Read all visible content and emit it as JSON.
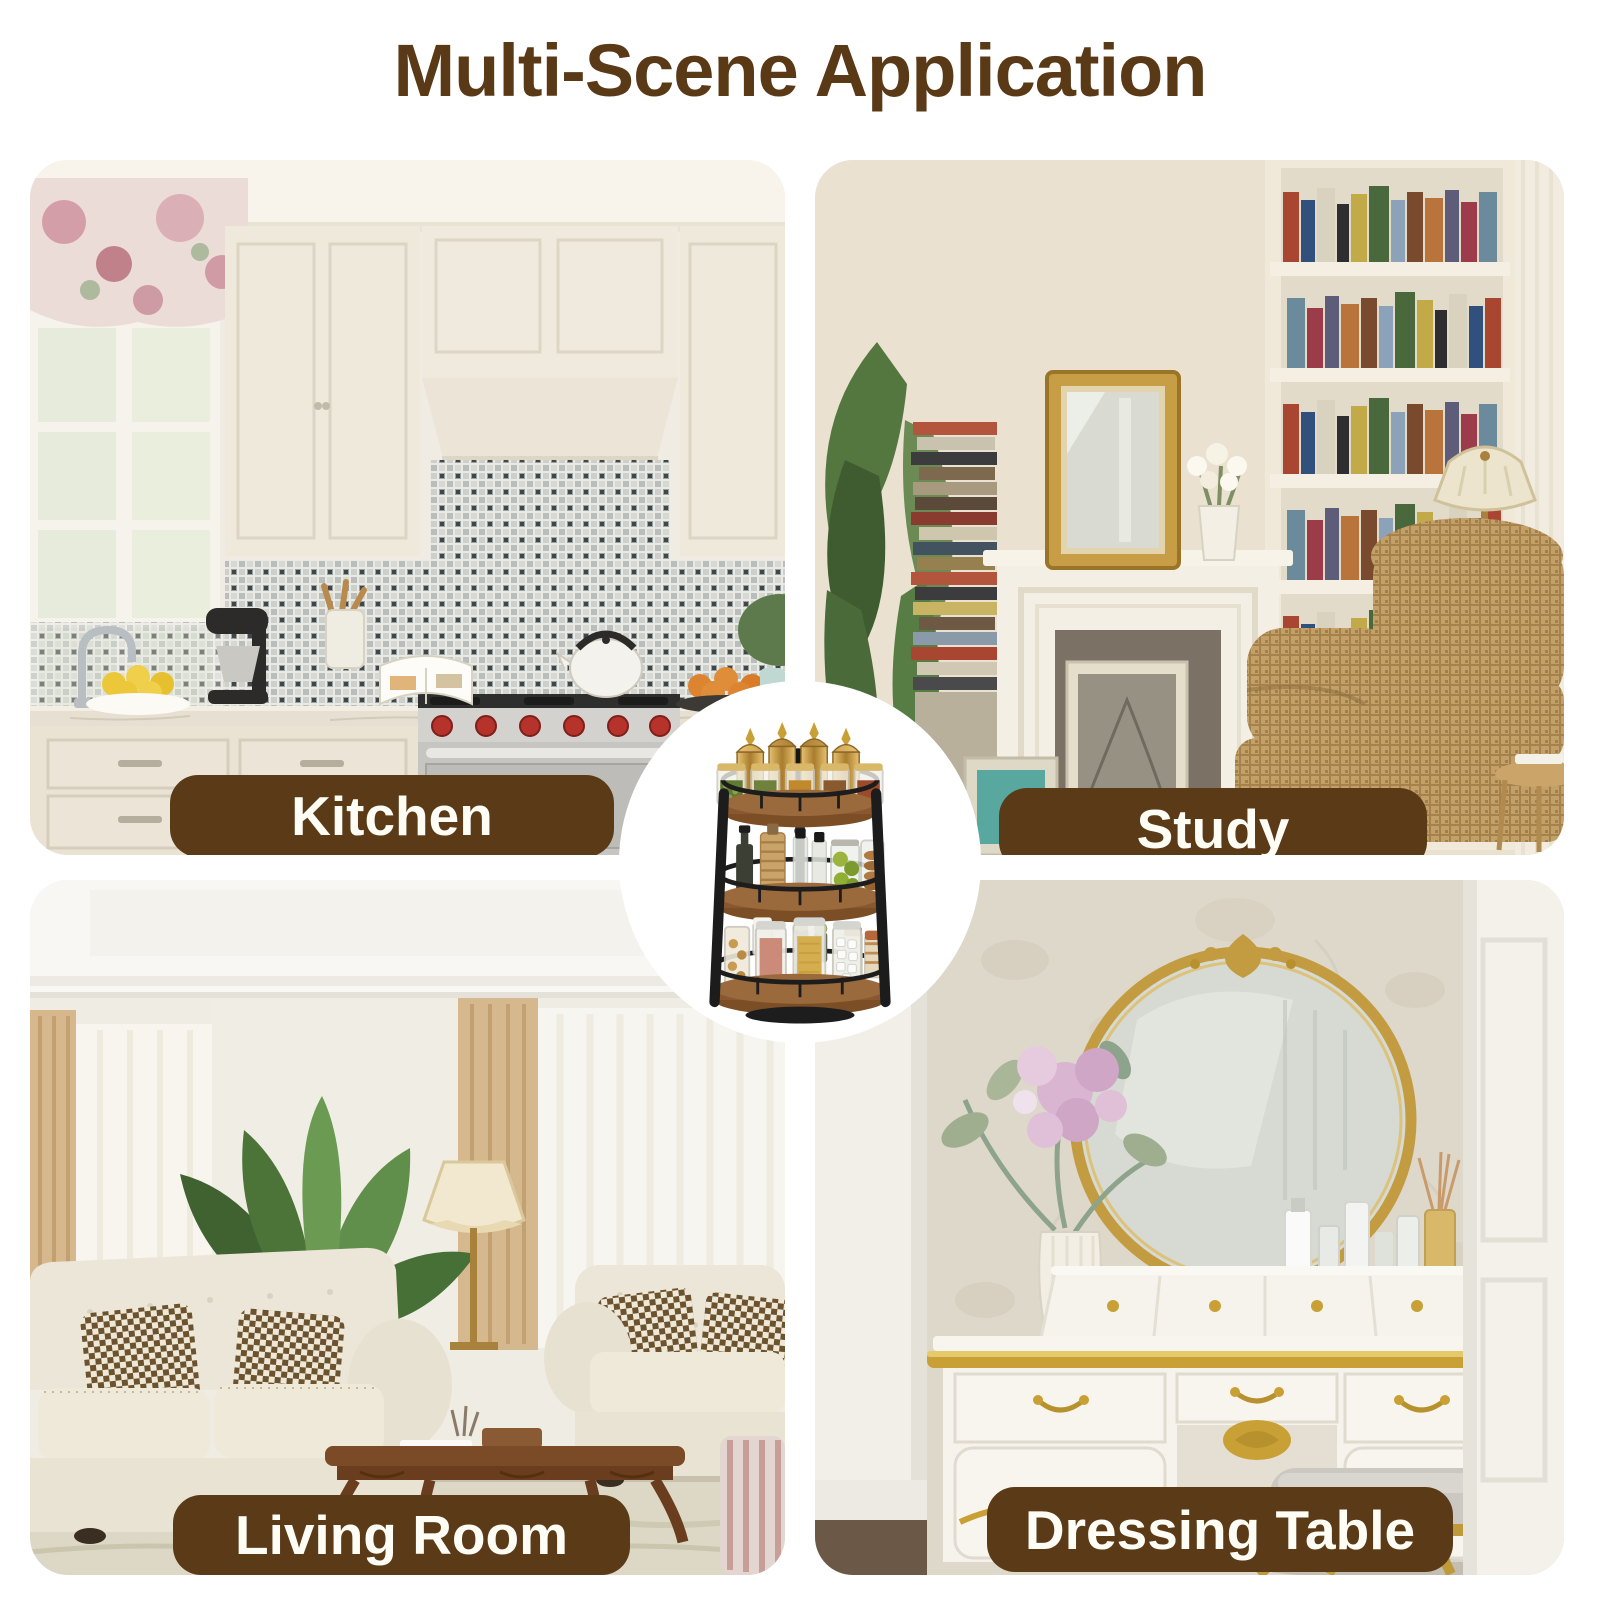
{
  "title": {
    "text": "Multi-Scene Application",
    "color": "#5a3a16"
  },
  "scenes": [
    {
      "id": "kitchen",
      "label": "Kitchen"
    },
    {
      "id": "study",
      "label": "Study"
    },
    {
      "id": "living-room",
      "label": "Living Room"
    },
    {
      "id": "dressing-table",
      "label": "Dressing Table"
    }
  ],
  "center_product": {
    "alt": "3-tier rotating wood and black metal spice rack filled with spice jars, oil bottles and canisters"
  },
  "style": {
    "accent_brown": "#5a3a16",
    "label_background": "#5b3b17",
    "label_text_color": "#fdfcf5",
    "page_background": "#ffffff"
  }
}
